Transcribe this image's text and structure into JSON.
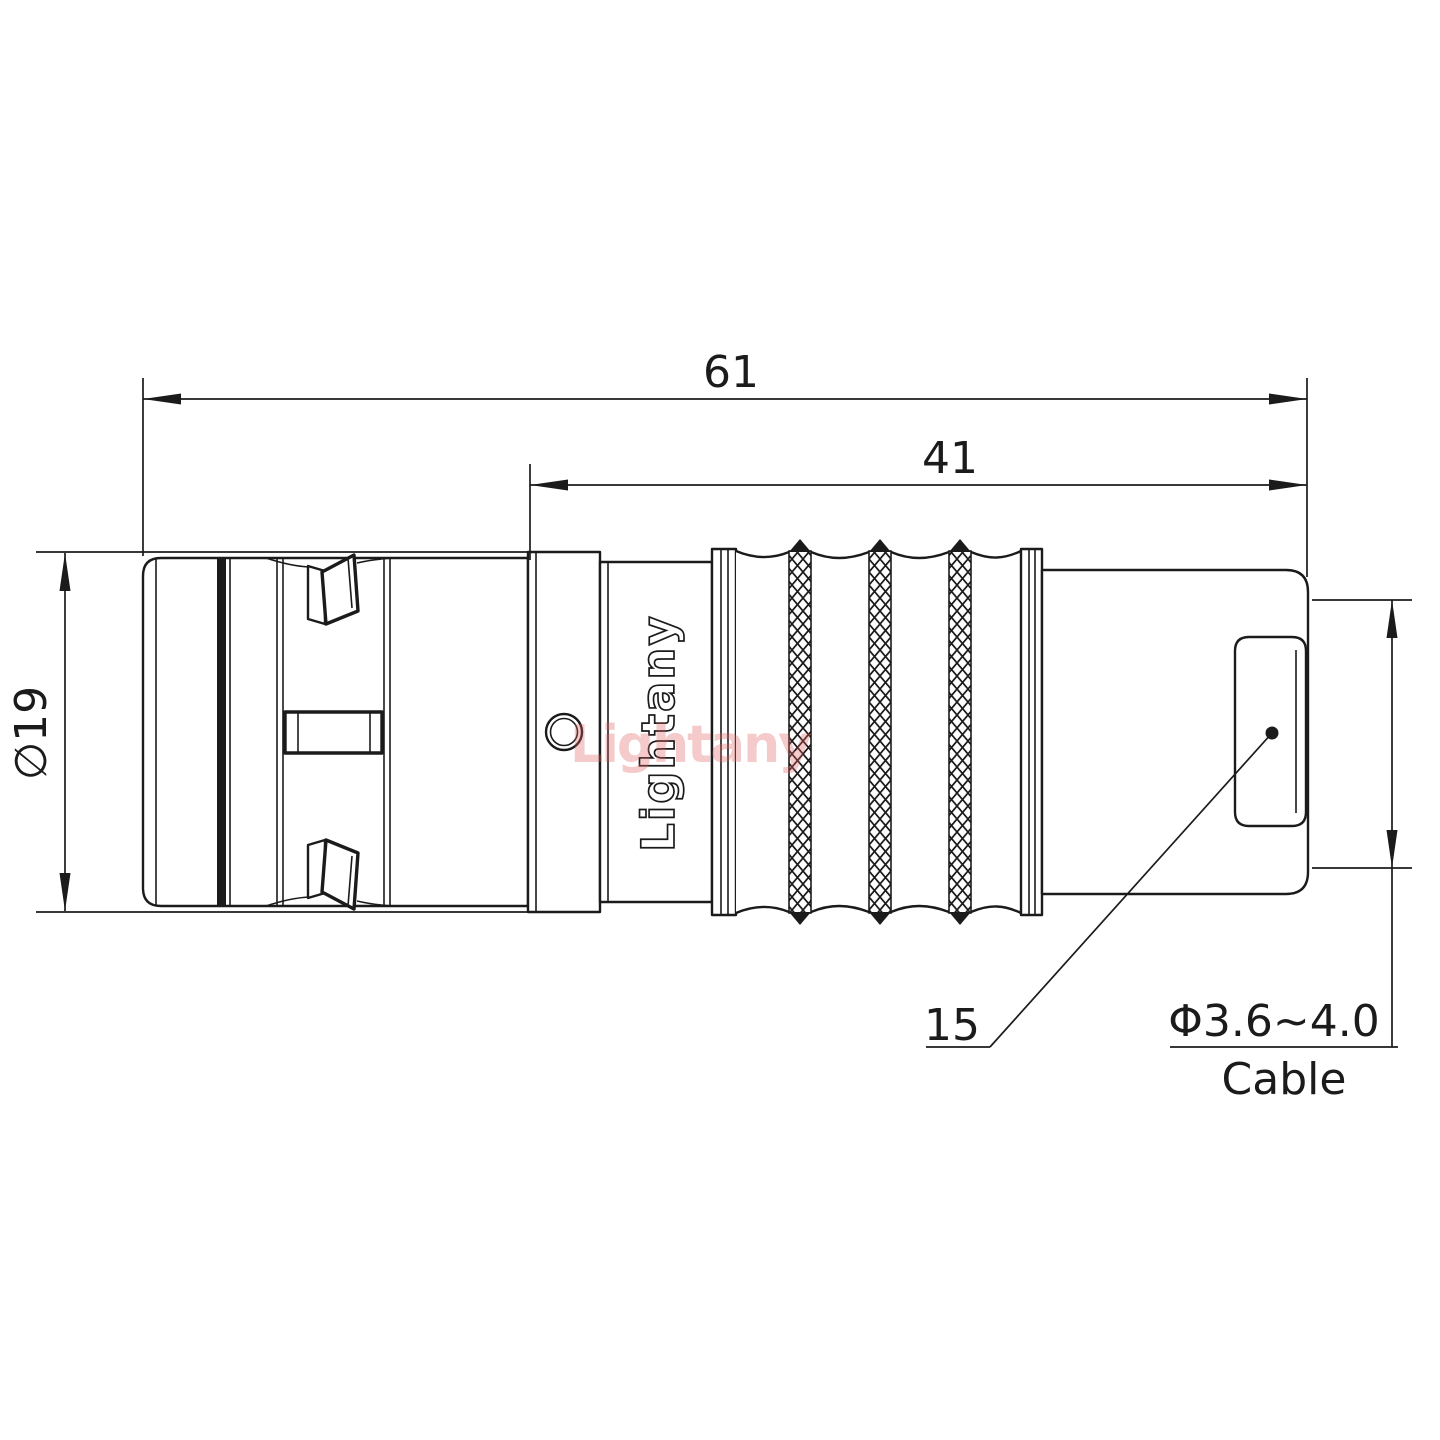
{
  "drawing": {
    "brand": "Lightany",
    "watermark": "Lightany",
    "dimensions": {
      "overall_length": "61",
      "rear_length": "41",
      "shell_diameter": "∅19",
      "boot_ref": "15",
      "cable_range": "Φ3.6~4.0",
      "cable_label": "Cable"
    },
    "colors": {
      "line": "#1b1b1b",
      "watermark": "#e06060",
      "background": "#ffffff"
    }
  }
}
